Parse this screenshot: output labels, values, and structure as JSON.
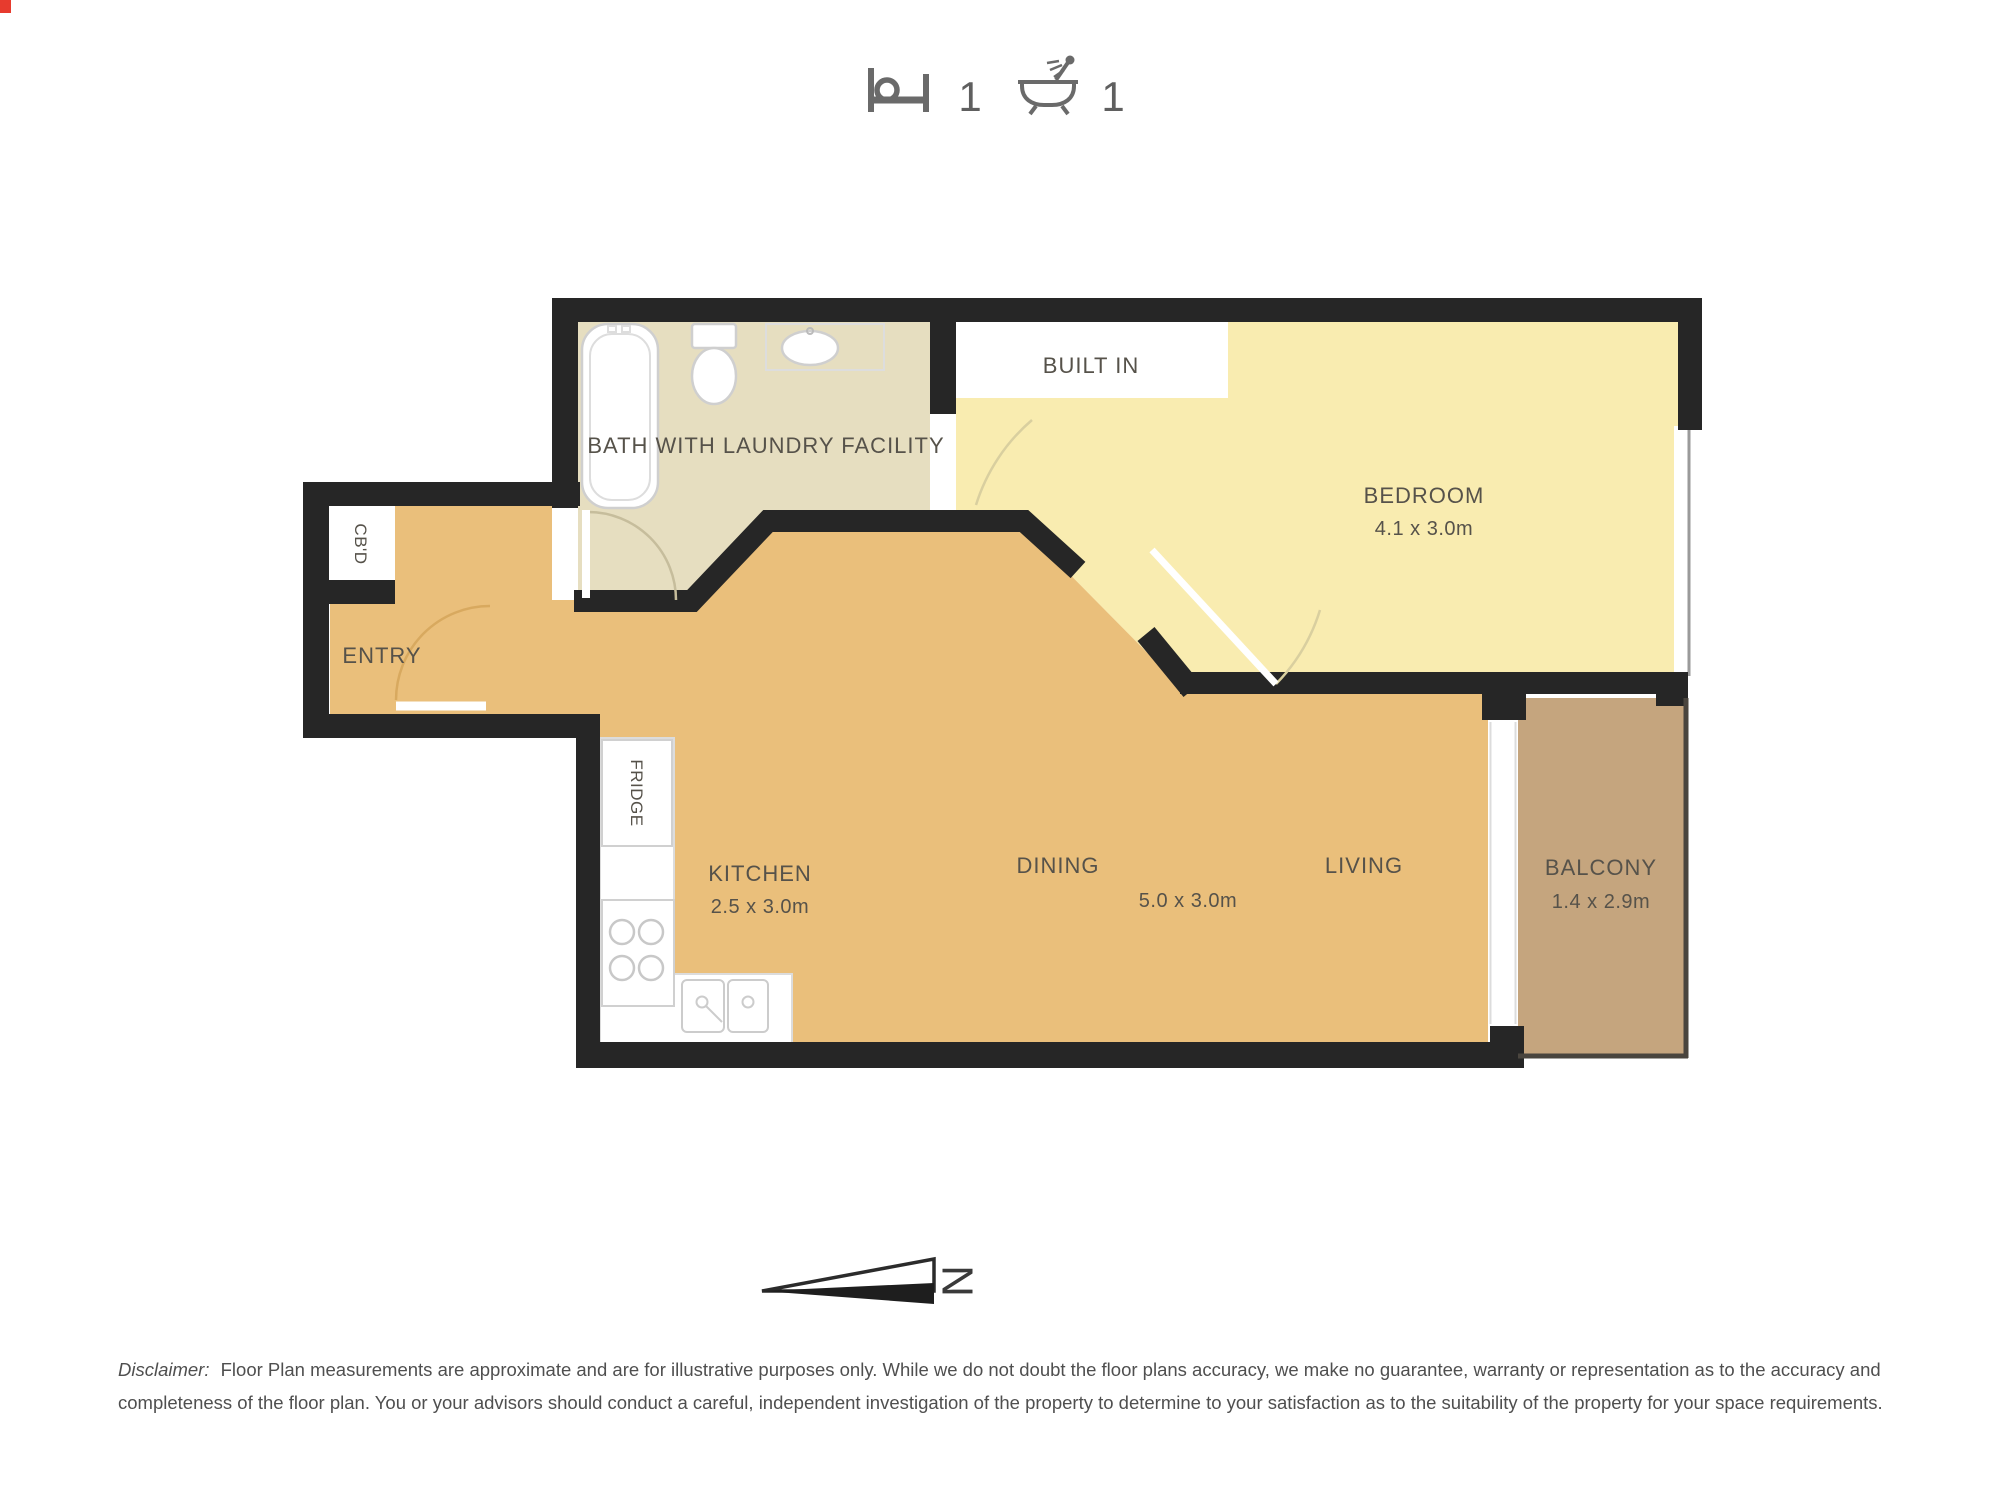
{
  "header": {
    "bed_count": "1",
    "bath_count": "1"
  },
  "icons": {
    "bed": "bed-icon",
    "bath": "bathtub-icon",
    "north_arrow": "north-arrow-icon"
  },
  "plan": {
    "colors": {
      "wall": "#262626",
      "bathroom_floor": "#e6dec0",
      "bedroom_floor": "#f9ecb0",
      "main_floor": "#eabf7b",
      "balcony_floor": "#c5a57e",
      "balcony_edge": "#4a453e",
      "fixture_outline": "#cccccc",
      "label_text": "#56524a"
    },
    "labels": {
      "bath": "BATH WITH LAUNDRY FACILITY",
      "built_in": "BUILT IN",
      "bedroom": "BEDROOM",
      "bedroom_dims": "4.1 x 3.0m",
      "cbd": "CB'D",
      "entry": "ENTRY",
      "fridge": "FRIDGE",
      "kitchen": "KITCHEN",
      "kitchen_dims": "2.5 x 3.0m",
      "dining": "DINING",
      "living": "LIVING",
      "living_dining_dims": "5.0 x 3.0m",
      "balcony": "BALCONY",
      "balcony_dims": "1.4 x 2.9m"
    },
    "compass": {
      "north": "N"
    }
  },
  "disclaimer": {
    "prefix": "Disclaimer:",
    "line1": "Floor Plan measurements are approximate and are for illustrative purposes only. While we do not doubt the floor plans accuracy, we make no guarantee, warranty or representation as to the accuracy and",
    "line2": "completeness of the floor plan. You or your advisors should conduct a careful, independent investigation of the property to determine to your satisfaction as to the suitability of the property for your space requirements."
  }
}
